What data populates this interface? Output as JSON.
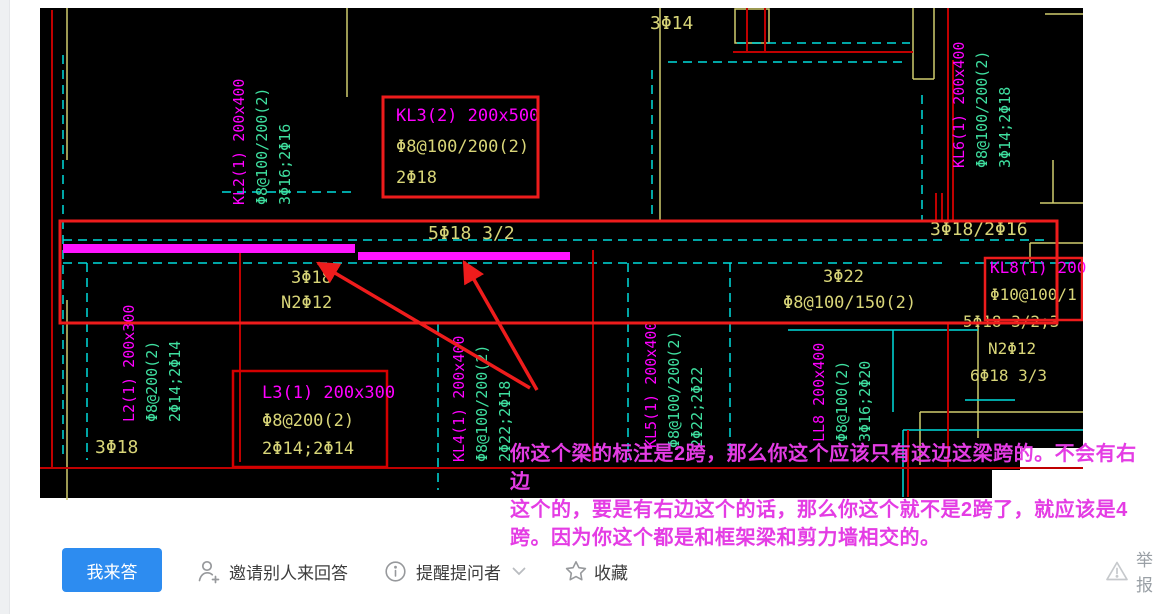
{
  "cad_view": {
    "beam_labels": {
      "kl2": {
        "name": "KL2(1) 200x400",
        "stirrup": "Φ8@100/200(2)",
        "rebar": "3Φ16;2Φ16"
      },
      "kl3": {
        "name": "KL3(2) 200x500",
        "stirrup": "Φ8@100/200(2)",
        "rebar": "2Φ18"
      },
      "kl4": {
        "name": "KL4(1) 200x400",
        "stirrup": "Φ8@100/200(2)",
        "rebar": "2Φ22;2Φ18"
      },
      "kl5": {
        "name": "KL5(1) 200x400",
        "stirrup": "Φ8@100/200(2)",
        "rebar": "2Φ22;2Φ22"
      },
      "kl6": {
        "name": "KL6(1) 200x400",
        "stirrup": "Φ8@100/200(2)",
        "rebar": "3Φ14;2Φ18"
      },
      "l2": {
        "name": "L2(1) 200x300",
        "stirrup": "Φ8@200(2)",
        "rebar": "2Φ14;2Φ14"
      },
      "l3": {
        "name": "L3(1) 200x300",
        "stirrup": "Φ8@200(2)",
        "rebar": "2Φ14;2Φ14"
      },
      "ll8": {
        "name": "LL8 200x400",
        "stirrup": "Φ8@100(2)",
        "rebar": "3Φ16;2Φ20"
      },
      "kl8": {
        "name": "KL8(1) 200",
        "stirrup": "Φ10@100/1",
        "top_bars": "5Φ18 3/2;3",
        "side_bars": "N2Φ12",
        "bottom_bars": "6Φ18 3/3"
      }
    },
    "span_notes": {
      "top_3phi14": "3Φ14",
      "span_5phi18": "5Φ18 3/2",
      "right_3phi18": "3Φ18/2Φ16",
      "mid_3phi18": "3Φ18",
      "mid_n2phi12": "N2Φ12",
      "bottomleft_3phi18": "3Φ18",
      "mid_3phi22": "3Φ22",
      "mid_phi8": "Φ8@100/150(2)"
    },
    "annotation": {
      "line1": "你这个梁的标注是2跨，那么你这个应该只有这边这梁跨的。不会有右边",
      "line2": "这个的，要是有右边这个的话，那么你这个就不是2跨了，就应该是4",
      "line3": "跨。因为你这个都是和框架梁和剪力墙相交的。"
    },
    "colors": {
      "beam_name": "#ff00ff",
      "stirrup_text": "#3fe0a0",
      "dim_text": "#d8d578",
      "highlight_bar": "#ff14ff",
      "annotation_red": "#ee1c1c",
      "annotation_text": "#e43ce4"
    }
  },
  "toolbar": {
    "answer_label": "我来答",
    "invite_label": "邀请别人来回答",
    "remind_label": "提醒提问者",
    "favorite_label": "收藏",
    "report_label": "举报",
    "primary_color": "#2d8cf0"
  }
}
